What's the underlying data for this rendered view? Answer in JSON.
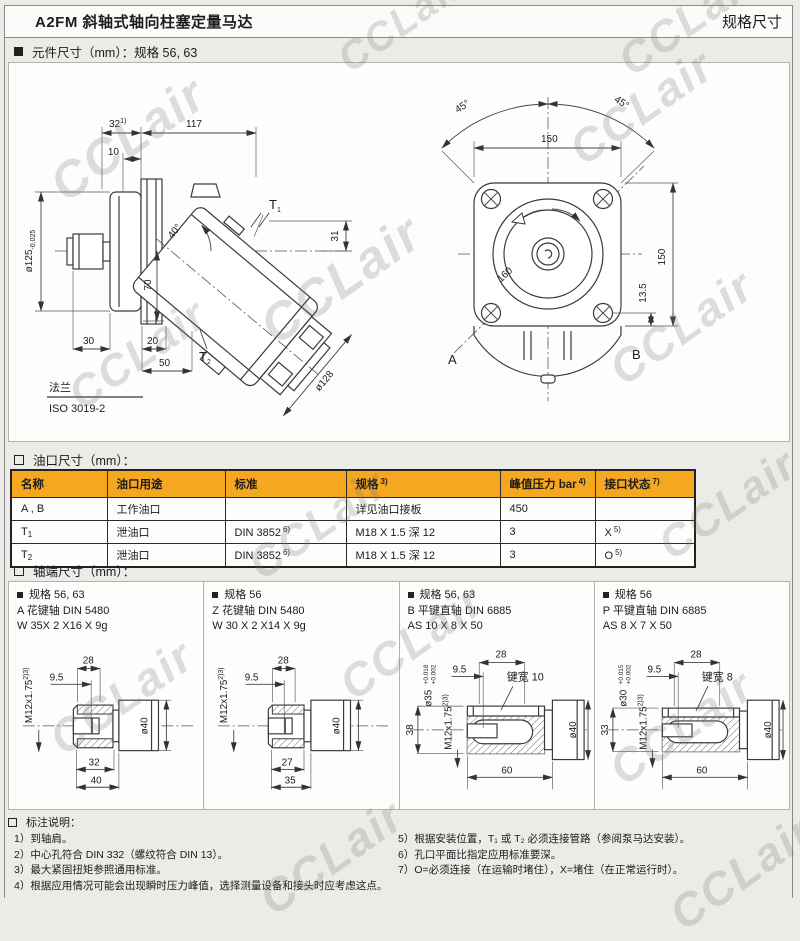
{
  "watermark": "CCLair",
  "header": {
    "title": "A2FM 斜轴式轴向柱塞定量马达",
    "right": "规格尺寸"
  },
  "sections": {
    "component": "元件尺寸（mm）：规格 56, 63",
    "ports": "油口尺寸（mm）：",
    "shafts": "轴端尺寸（mm）：",
    "notes": "标注说明："
  },
  "left_drawing": {
    "dim32": "32",
    "dim32_sup": "1)",
    "dim117": "117",
    "dim10": "10",
    "d125": "ø125",
    "d125_tol": "-0.025",
    "dim70": "70",
    "dim31": "31",
    "angle40": "40°",
    "t1": "T",
    "t1_sub": "1",
    "t2": "T",
    "t2_sub": "2",
    "dim30": "30",
    "dim20": "20",
    "dim50": "50",
    "d128": "ø128",
    "flange_cn": "法兰",
    "flange_std": "ISO 3019-2"
  },
  "right_drawing": {
    "angle_l": "45°",
    "angle_r": "45°",
    "dim150_top": "150",
    "dim160": "160",
    "dim150_right": "150",
    "dim135": "13.5",
    "label_a": "A",
    "label_b": "B"
  },
  "ports": {
    "headers": [
      {
        "text": "名称",
        "sup": ""
      },
      {
        "text": "油口用途",
        "sup": ""
      },
      {
        "text": "标准",
        "sup": ""
      },
      {
        "text": "规格",
        "sup": "3)"
      },
      {
        "text": "峰值压力 bar",
        "sup": "4)"
      },
      {
        "text": "接口状态",
        "sup": "7)"
      }
    ],
    "rows": [
      {
        "name": "A , B",
        "name_sub": "",
        "use": "工作油口",
        "std": "",
        "std_sup": "",
        "spec": "详见油口接板",
        "pressure": "450",
        "state": "",
        "state_sup": ""
      },
      {
        "name": "T",
        "name_sub": "1",
        "use": "泄油口",
        "std": "DIN 3852",
        "std_sup": "6)",
        "spec": "M18 X 1.5 深 12",
        "pressure": "3",
        "state": "X",
        "state_sup": "5)"
      },
      {
        "name": "T",
        "name_sub": "2",
        "use": "泄油口",
        "std": "DIN 3852",
        "std_sup": "6)",
        "spec": "M18 X 1.5 深 12",
        "pressure": "3",
        "state": "O",
        "state_sup": "5)"
      }
    ]
  },
  "shafts": {
    "panels": [
      {
        "spec": "规格 56, 63",
        "type": "A 花键轴 DIN 5480",
        "size": "W 35X 2 X16 X 9g",
        "thread": "M12x1.75",
        "thread_sup": "2)3)",
        "d95": "9.5",
        "d28": "28",
        "d40": "ø40",
        "len1": "32",
        "len2": "40"
      },
      {
        "spec": "规格 56",
        "type": "Z 花键轴 DIN 5480",
        "size": "W 30 X 2 X14 X 9g",
        "thread": "M12x1.75",
        "thread_sup": "2)3)",
        "d95": "9.5",
        "d28": "28",
        "d40": "ø40",
        "len1": "27",
        "len2": "35"
      },
      {
        "spec": "规格 56, 63",
        "type": "B 平键直轴 DIN 6885",
        "size": "AS 10 X 8 X 50",
        "thread": "M12x1.75",
        "thread_sup": "2)3)",
        "d95": "9.5",
        "d28": "28",
        "d40": "ø40",
        "dia": "ø35",
        "tol_top": "+0.018",
        "tol_bot": "+0.002",
        "height": "38",
        "key": "键宽 10",
        "len": "60"
      },
      {
        "spec": "规格 56",
        "type": "P 平键直轴 DIN 6885",
        "size": "AS 8 X 7 X 50",
        "thread": "M12x1.75",
        "thread_sup": "2)3)",
        "d95": "9.5",
        "d28": "28",
        "d40": "ø40",
        "dia": "ø30",
        "tol_top": "+0.015",
        "tol_bot": "+0.002",
        "height": "33",
        "key": "键宽 8",
        "len": "60"
      }
    ]
  },
  "notes": {
    "left": [
      "1）到轴肩。",
      "2）中心孔符合 DIN 332（螺纹符合 DIN 13）。",
      "3）最大紧固扭矩参照通用标准。",
      "4）根据应用情况可能会出现瞬时压力峰值，选择测量设备和接头时应考虑这点。"
    ],
    "right": [
      "5）根据安装位置，T₁ 或 T₂ 必须连接管路（参阅泵马达安装）。",
      "6）孔口平面比指定应用标准要深。",
      "7）O=必须连接（在运输时堵住），X=堵住（在正常运行时）。"
    ]
  },
  "colors": {
    "table_header": "#F5A71F",
    "line": "#3a3a3a",
    "page_bg": "#ecebe8"
  }
}
